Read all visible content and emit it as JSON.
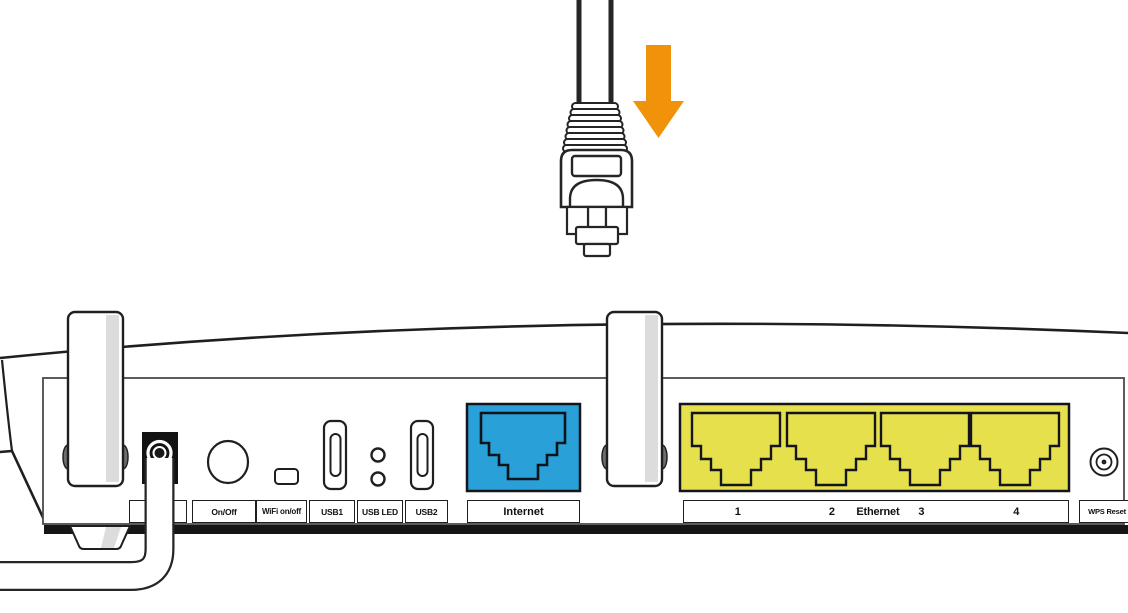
{
  "colors": {
    "outline": "#222222",
    "internet_port": "#29A0D8",
    "ethernet_block": "#E6E04C",
    "arrow": "#F0930B",
    "antenna_shade": "#DCDCDC",
    "port_black": "#131313"
  },
  "router": {
    "back_panel_labels": {
      "power": "Power",
      "on_off": "On/Off",
      "wifi_on_off": "WiFi on/off",
      "usb1": "USB1",
      "usb_led": "USB LED",
      "usb2": "USB2",
      "internet": "Internet",
      "wps_reset": "WPS Reset"
    },
    "ethernet_bar": {
      "port1": "1",
      "port2": "2",
      "group_label": "Ethernet",
      "port3": "3",
      "port4": "4"
    }
  }
}
